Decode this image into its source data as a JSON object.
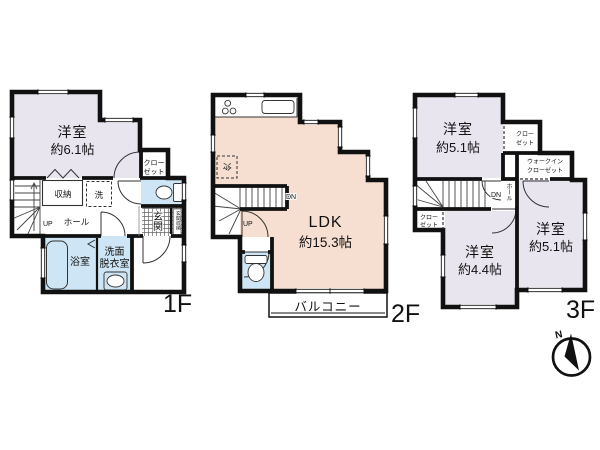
{
  "colors": {
    "wall": "#111111",
    "western_room_fill": "#e8e5ee",
    "ldk_fill": "#f6dfd0",
    "wet_area_fill": "#cde5f4",
    "background": "#ffffff"
  },
  "floor1": {
    "label": "1F",
    "room_name": "洋室",
    "room_size": "約6.1帖",
    "storage": "収納",
    "washer": "洗",
    "up": "UP",
    "hall": "ホール",
    "closet_line1": "クロー",
    "closet_line2": "ゼット",
    "entrance": "玄関",
    "entrance_storage": "玄関収納",
    "bath": "浴室",
    "washroom_line1": "洗面",
    "washroom_line2": "脱衣室"
  },
  "floor2": {
    "label": "2F",
    "ldk_name": "LDK",
    "ldk_size": "約15.3帖",
    "fridge": "冷",
    "dn": "DN",
    "up": "UP",
    "balcony": "バルコニー"
  },
  "floor3": {
    "label": "3F",
    "room_top_name": "洋室",
    "room_top_size": "約5.1帖",
    "closet_top_line1": "クロー",
    "closet_top_line2": "ゼット",
    "wic_line1": "ウォークイン",
    "wic_line2": "クローゼット",
    "dn": "DN",
    "hall": "ホール",
    "closet_left_line1": "クロー",
    "closet_left_line2": "ゼット",
    "room_mid_name": "洋室",
    "room_mid_size": "約4.4帖",
    "room_right_name": "洋室",
    "room_right_size": "約5.1帖"
  },
  "compass": {
    "north_label": "N"
  }
}
